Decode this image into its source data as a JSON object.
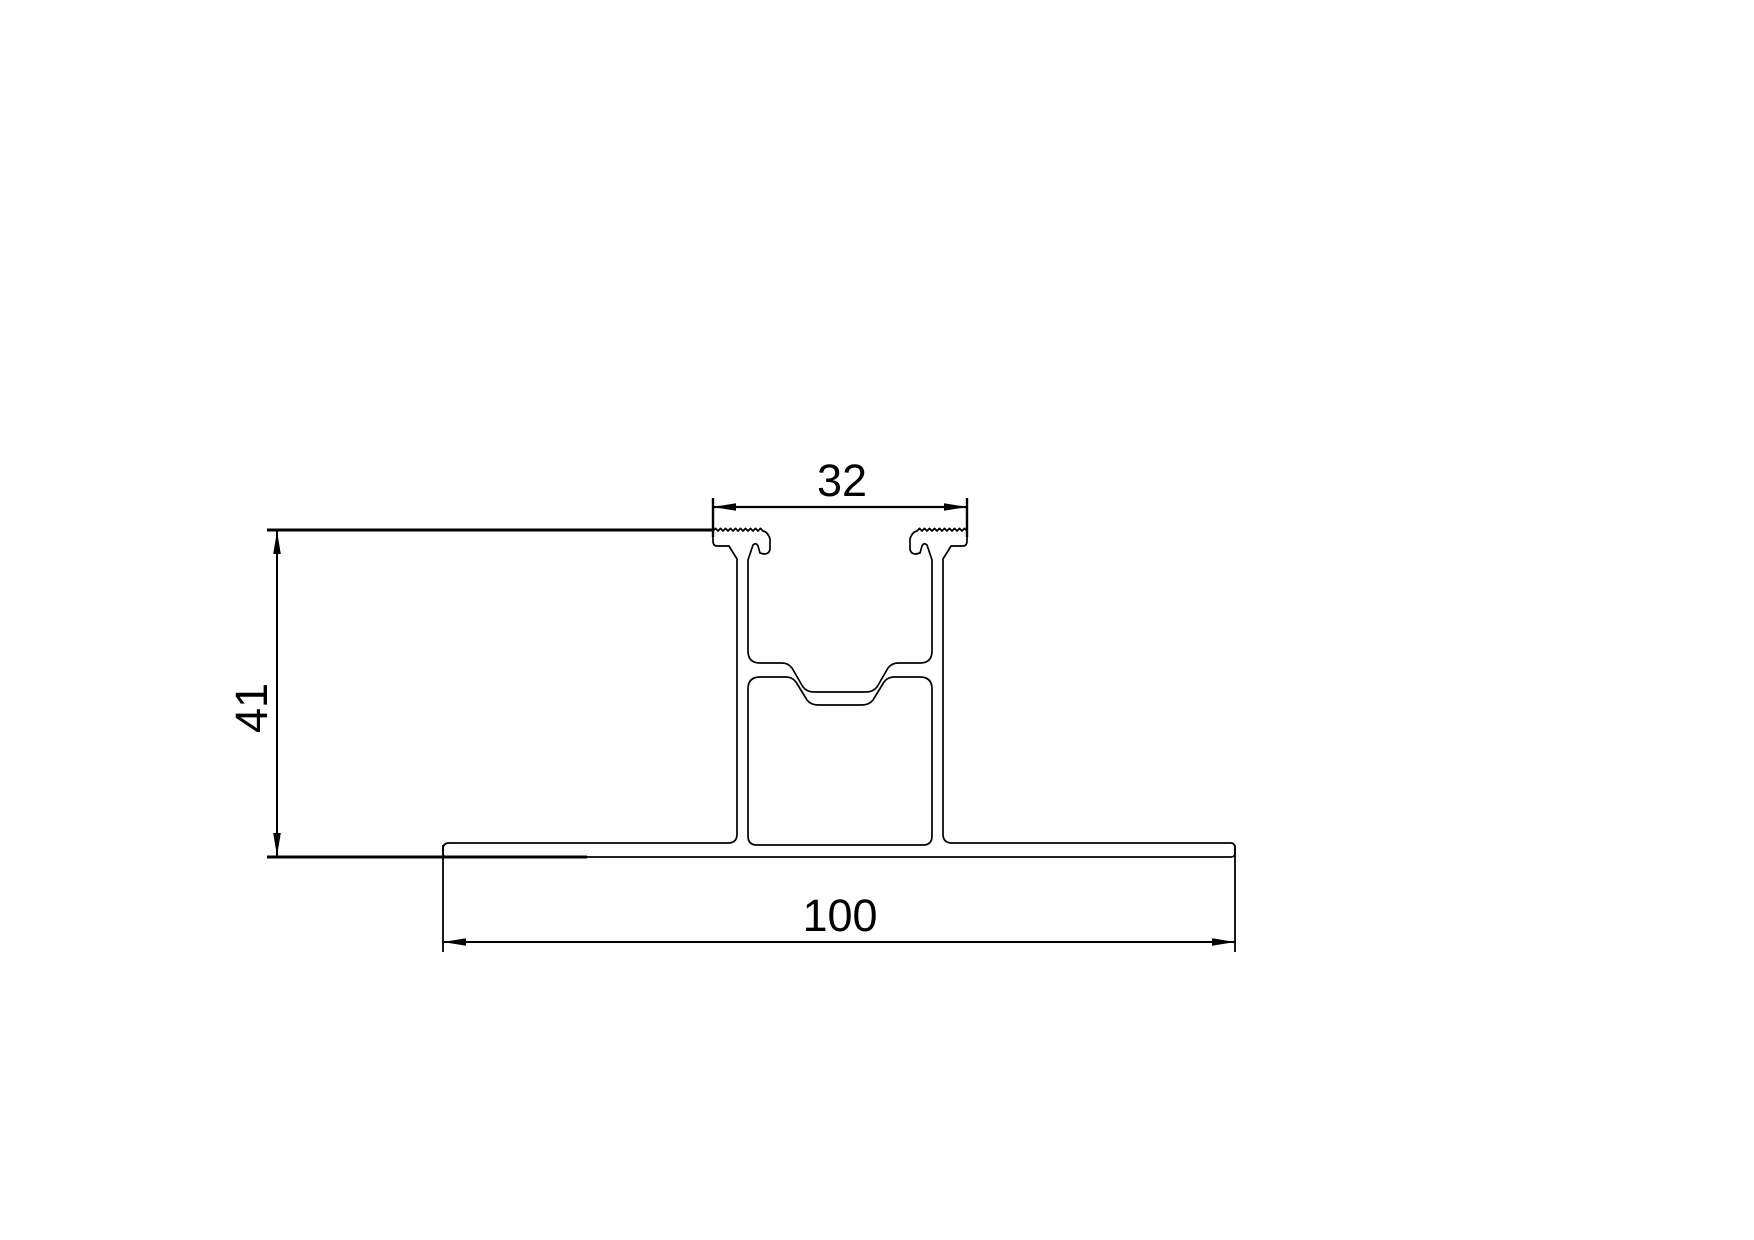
{
  "drawing": {
    "kind": "extrusion-profile-cross-section",
    "background_color": "#ffffff",
    "line_color": "#000000",
    "dimensions": {
      "slot_width": {
        "label": "32"
      },
      "height": {
        "label": "41"
      },
      "base_width": {
        "label": "100"
      }
    }
  }
}
